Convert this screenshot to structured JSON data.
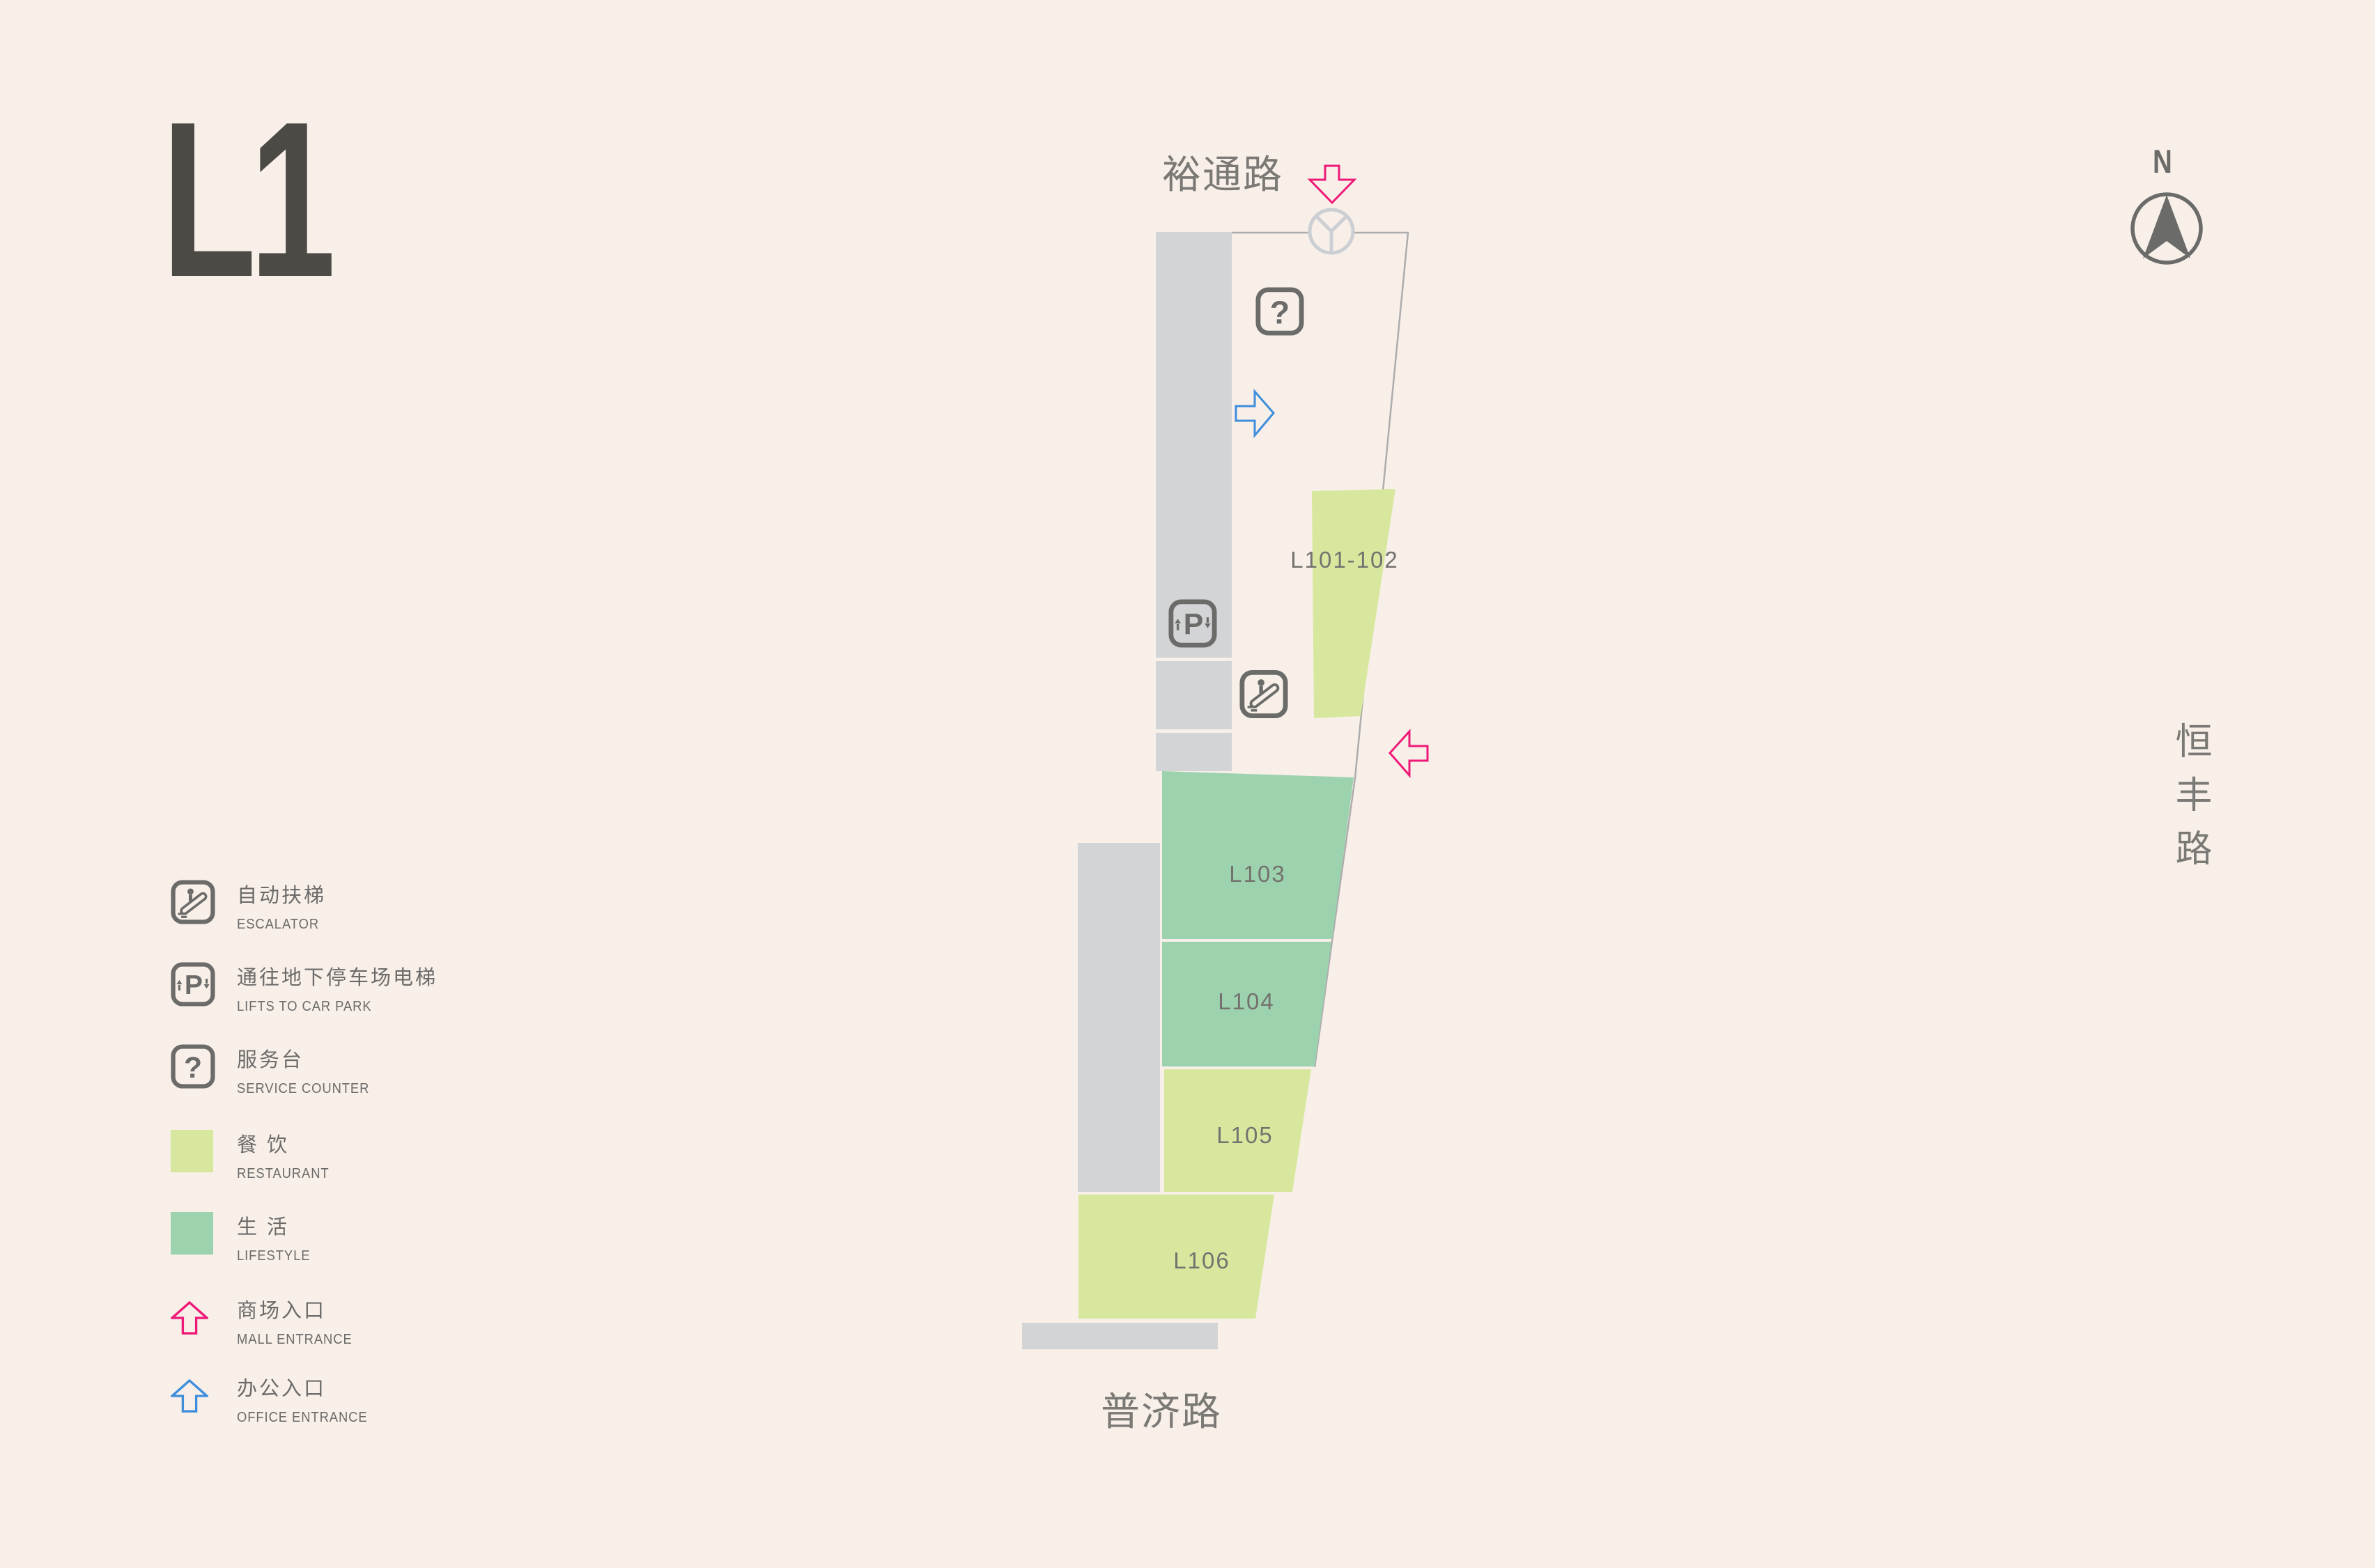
{
  "title": {
    "floor": "L1"
  },
  "compass": {
    "label": "N"
  },
  "streets": {
    "top": "裕通路",
    "right": "恒丰路",
    "bottom": "普济路"
  },
  "icons": {
    "question_glyph": "?",
    "parking_glyph": "P"
  },
  "legend": {
    "escalator": {
      "zh": "自动扶梯",
      "en": "ESCALATOR"
    },
    "lifts": {
      "zh": "通往地下停车场电梯",
      "en": "LIFTS TO CAR PARK"
    },
    "service": {
      "zh": "服务台",
      "en": "SERVICE COUNTER"
    },
    "restaurant": {
      "zh": "餐 饮",
      "en": "RESTAURANT",
      "color": "#D7E89E"
    },
    "lifestyle": {
      "zh": "生 活",
      "en": "LIFESTYLE",
      "color": "#9DD2AE"
    },
    "mall_entrance": {
      "zh": "商场入口",
      "en": "MALL ENTRANCE",
      "color": "#EE1A77"
    },
    "office_entrance": {
      "zh": "办公入口",
      "en": "OFFICE ENTRANCE",
      "color": "#3E8EDC"
    }
  },
  "map": {
    "units": [
      {
        "label": "L101-102",
        "category": "restaurant"
      },
      {
        "label": "L103",
        "category": "lifestyle"
      },
      {
        "label": "L104",
        "category": "lifestyle"
      },
      {
        "label": "L105",
        "category": "restaurant"
      },
      {
        "label": "L106",
        "category": "restaurant"
      }
    ]
  },
  "colors": {
    "background": "#F8EFE9",
    "corridor": "#D2D4D6",
    "restaurant": "#D7E89E",
    "lifestyle": "#9DD2AE",
    "accent_pink": "#EE1A77",
    "accent_blue": "#3E8EDC",
    "ink": "#6B6B69",
    "outline": "#ADADAD",
    "door_circle": "#CBCFD3",
    "unit_label": "#74726E"
  }
}
